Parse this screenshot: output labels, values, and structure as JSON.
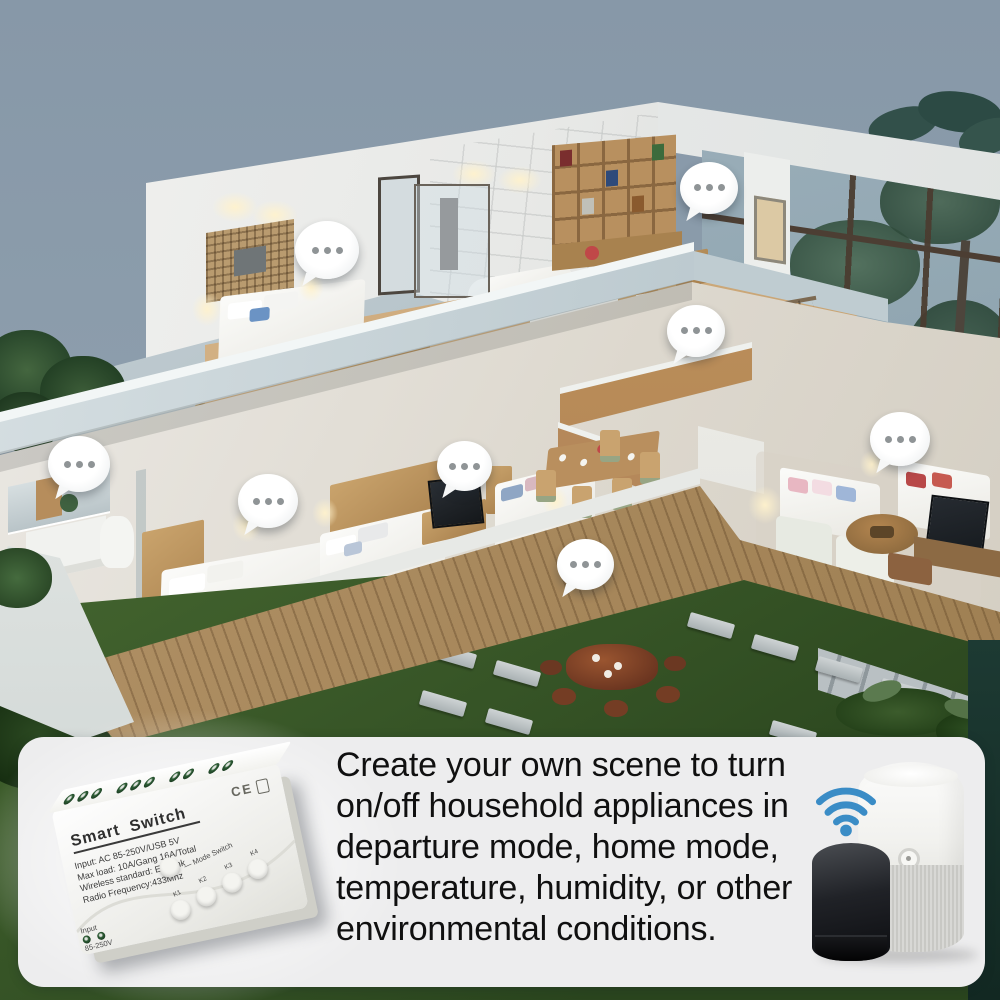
{
  "panel": {
    "description_lines": [
      "Create your own scene to turn",
      "on/off household appliances in",
      "departure mode, home mode,",
      "temperature, humidity, or other",
      "environmental conditions."
    ]
  },
  "device": {
    "title": "Smart Switch",
    "spec_lines": [
      "Input:  AC 85-250V/USB 5V",
      "Max load:  10A/Gang 16A/Total",
      "Wireless standard:  Ewelink",
      "Radio Frequency:433Mhz"
    ],
    "certification_mark": "CE",
    "mode_switch_label": "— Mode Switch",
    "key_labels": [
      "K1",
      "K2",
      "K3",
      "K4"
    ],
    "input_label": "Input",
    "input_voltage": "85-250V"
  },
  "hotspots": {
    "icon": "chat-bubble-ellipsis-icon",
    "positions": [
      {
        "x": 327,
        "y": 250,
        "d": 64
      },
      {
        "x": 709,
        "y": 188,
        "d": 58
      },
      {
        "x": 696,
        "y": 331,
        "d": 58
      },
      {
        "x": 79,
        "y": 464,
        "d": 62
      },
      {
        "x": 268,
        "y": 501,
        "d": 60
      },
      {
        "x": 464,
        "y": 466,
        "d": 55
      },
      {
        "x": 585,
        "y": 565,
        "d": 57
      },
      {
        "x": 900,
        "y": 439,
        "d": 60
      }
    ]
  },
  "icons": {
    "wifi": "wifi-icon",
    "hotspot": "chat-bubble-ellipsis-icon",
    "white_speaker": "smart-speaker-white",
    "black_speaker": "smart-speaker-black"
  },
  "colors": {
    "sky": "#8b9cab",
    "wifi_blue": "#3a8cc6",
    "panel_background": "#ededee",
    "panel_text": "#101010",
    "lawn_green": "#41602c",
    "wood_floor": "#c9a878",
    "deck_wood": "#ab8c5e",
    "terrace_gray": "#bcc7cd",
    "bubble_dot_gray": "#8f9496"
  }
}
